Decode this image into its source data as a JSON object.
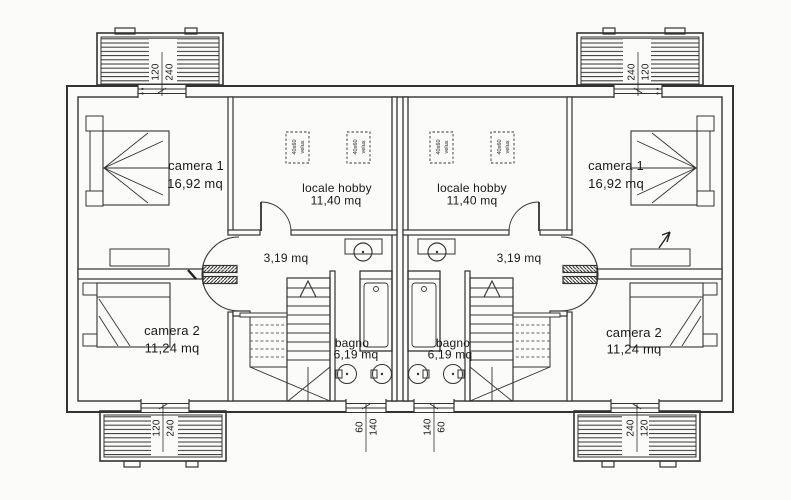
{
  "palette": {
    "ink": "#333333",
    "paper": "#fbfbf9"
  },
  "velux": {
    "size": "40x60",
    "brand": "velux"
  },
  "units": {
    "left": {
      "camera1": {
        "name": "camera 1",
        "area": "16,92 mq"
      },
      "hobby": {
        "name": "locale hobby",
        "area": "11,40 mq"
      },
      "corridor": {
        "area": "3,19 mq"
      },
      "camera2": {
        "name": "camera 2",
        "area": "11,24 mq"
      },
      "bagno": {
        "name": "bagno",
        "area": "6,19 mq"
      },
      "balcony_top_dims": [
        "120",
        "240"
      ],
      "balcony_bottom_dims": [
        "120",
        "240"
      ],
      "window_dims": [
        "60",
        "140"
      ]
    },
    "right": {
      "camera1": {
        "name": "camera 1",
        "area": "16,92 mq"
      },
      "hobby": {
        "name": "locale hobby",
        "area": "11,40 mq"
      },
      "corridor": {
        "area": "3,19 mq"
      },
      "camera2": {
        "name": "camera 2",
        "area": "11,24 mq"
      },
      "bagno": {
        "name": "bagno",
        "area": "6,19 mq"
      },
      "balcony_top_dims": [
        "240",
        "120"
      ],
      "balcony_bottom_dims": [
        "240",
        "120"
      ],
      "window_dims": [
        "140",
        "60"
      ]
    }
  }
}
